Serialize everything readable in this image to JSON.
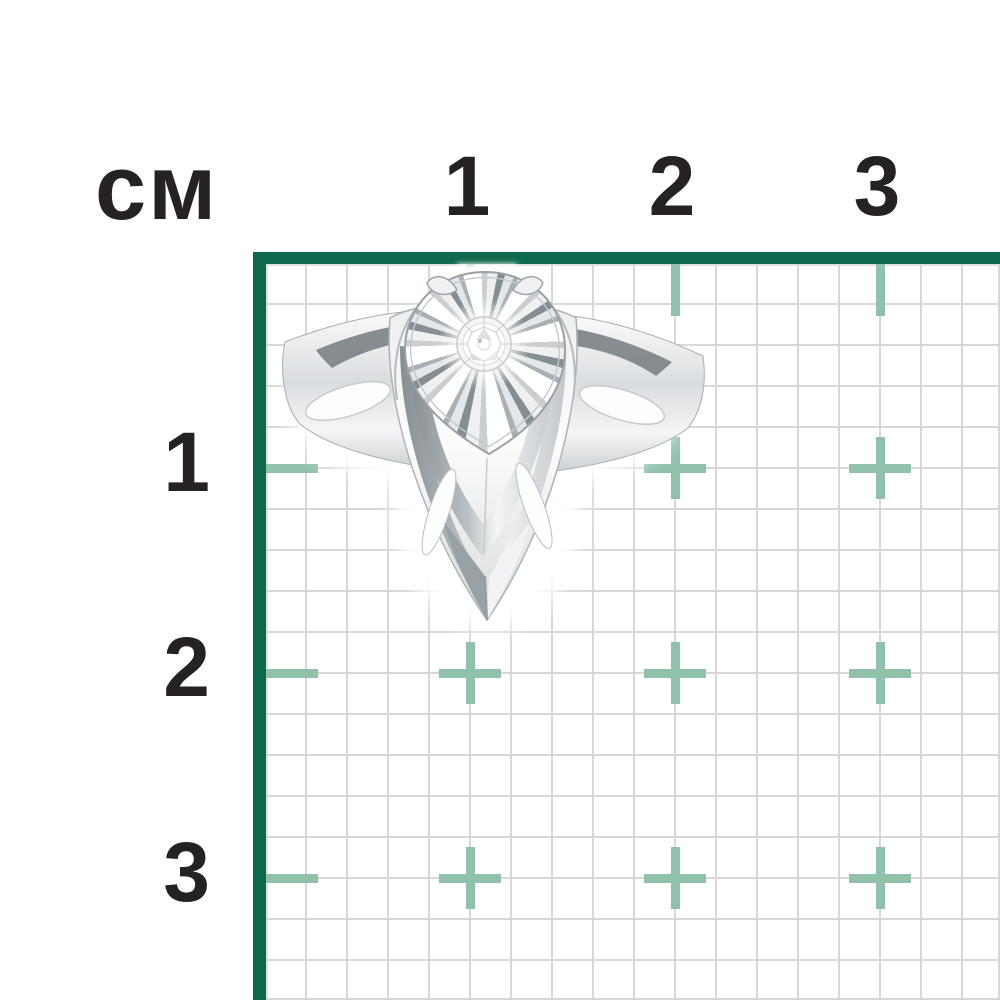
{
  "page": {
    "background": "#ffffff"
  },
  "ruler": {
    "unit_label": "см",
    "top_labels": [
      "1",
      "2",
      "3"
    ],
    "left_labels": [
      "1",
      "2",
      "3"
    ],
    "text_color": "#262223"
  },
  "grid": {
    "border_color": "#0d684d",
    "line_color": "#d8d8d8",
    "cross_color": "#8fc1ab",
    "cell_px": 41,
    "unit_px": 205,
    "cross_columns": [
      1,
      2,
      3
    ],
    "cross_rows": [
      1,
      2,
      3
    ],
    "tick_length_px": 52,
    "cross_size_px": 62,
    "mark_thickness_px": 9
  },
  "product": {
    "alt": "silver ring with round diamond in pear-shaped sunburst setting"
  }
}
